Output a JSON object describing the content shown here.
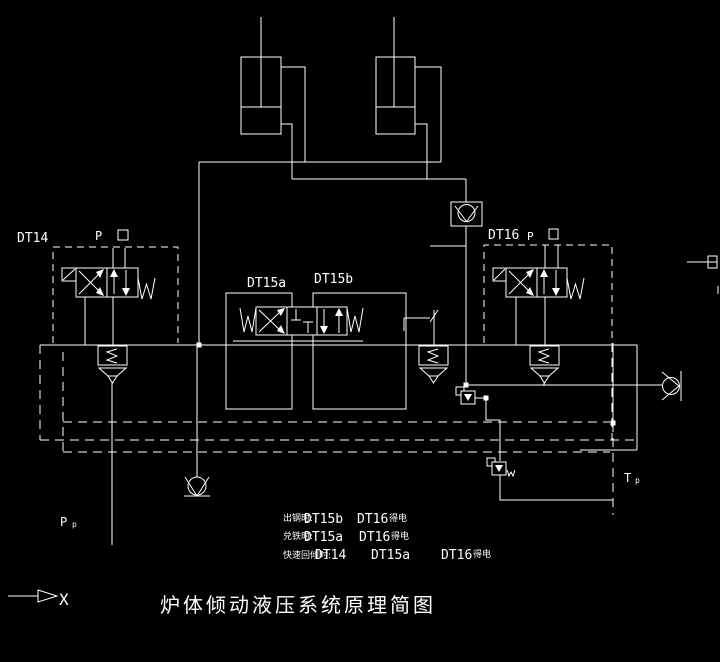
{
  "colors": {
    "background": "#000000",
    "line": "#ffffff"
  },
  "title": "炉体倾动液压系统原理简图",
  "labels": {
    "dt14": "DT14",
    "dt15a": "DT15a",
    "dt15b": "DT15b",
    "dt16": "DT16",
    "p_port_left": "P",
    "p_port_right": "P",
    "pump_line_main": "P",
    "pump_line_sub": "p",
    "tank_line_main": "T",
    "tank_line_sub": "p",
    "axis_marker": "X"
  },
  "legend": {
    "rows": [
      {
        "condition": "出钢时:",
        "codes": [
          "DT15b",
          "DT16"
        ],
        "suffix": "得电"
      },
      {
        "condition": "兑铁时:",
        "codes": [
          "DT15a",
          "DT16"
        ],
        "suffix": "得电"
      },
      {
        "condition": "快速回倾时:",
        "codes": [
          "DT14",
          "DT15a",
          "DT16"
        ],
        "suffix": "得电"
      }
    ]
  }
}
